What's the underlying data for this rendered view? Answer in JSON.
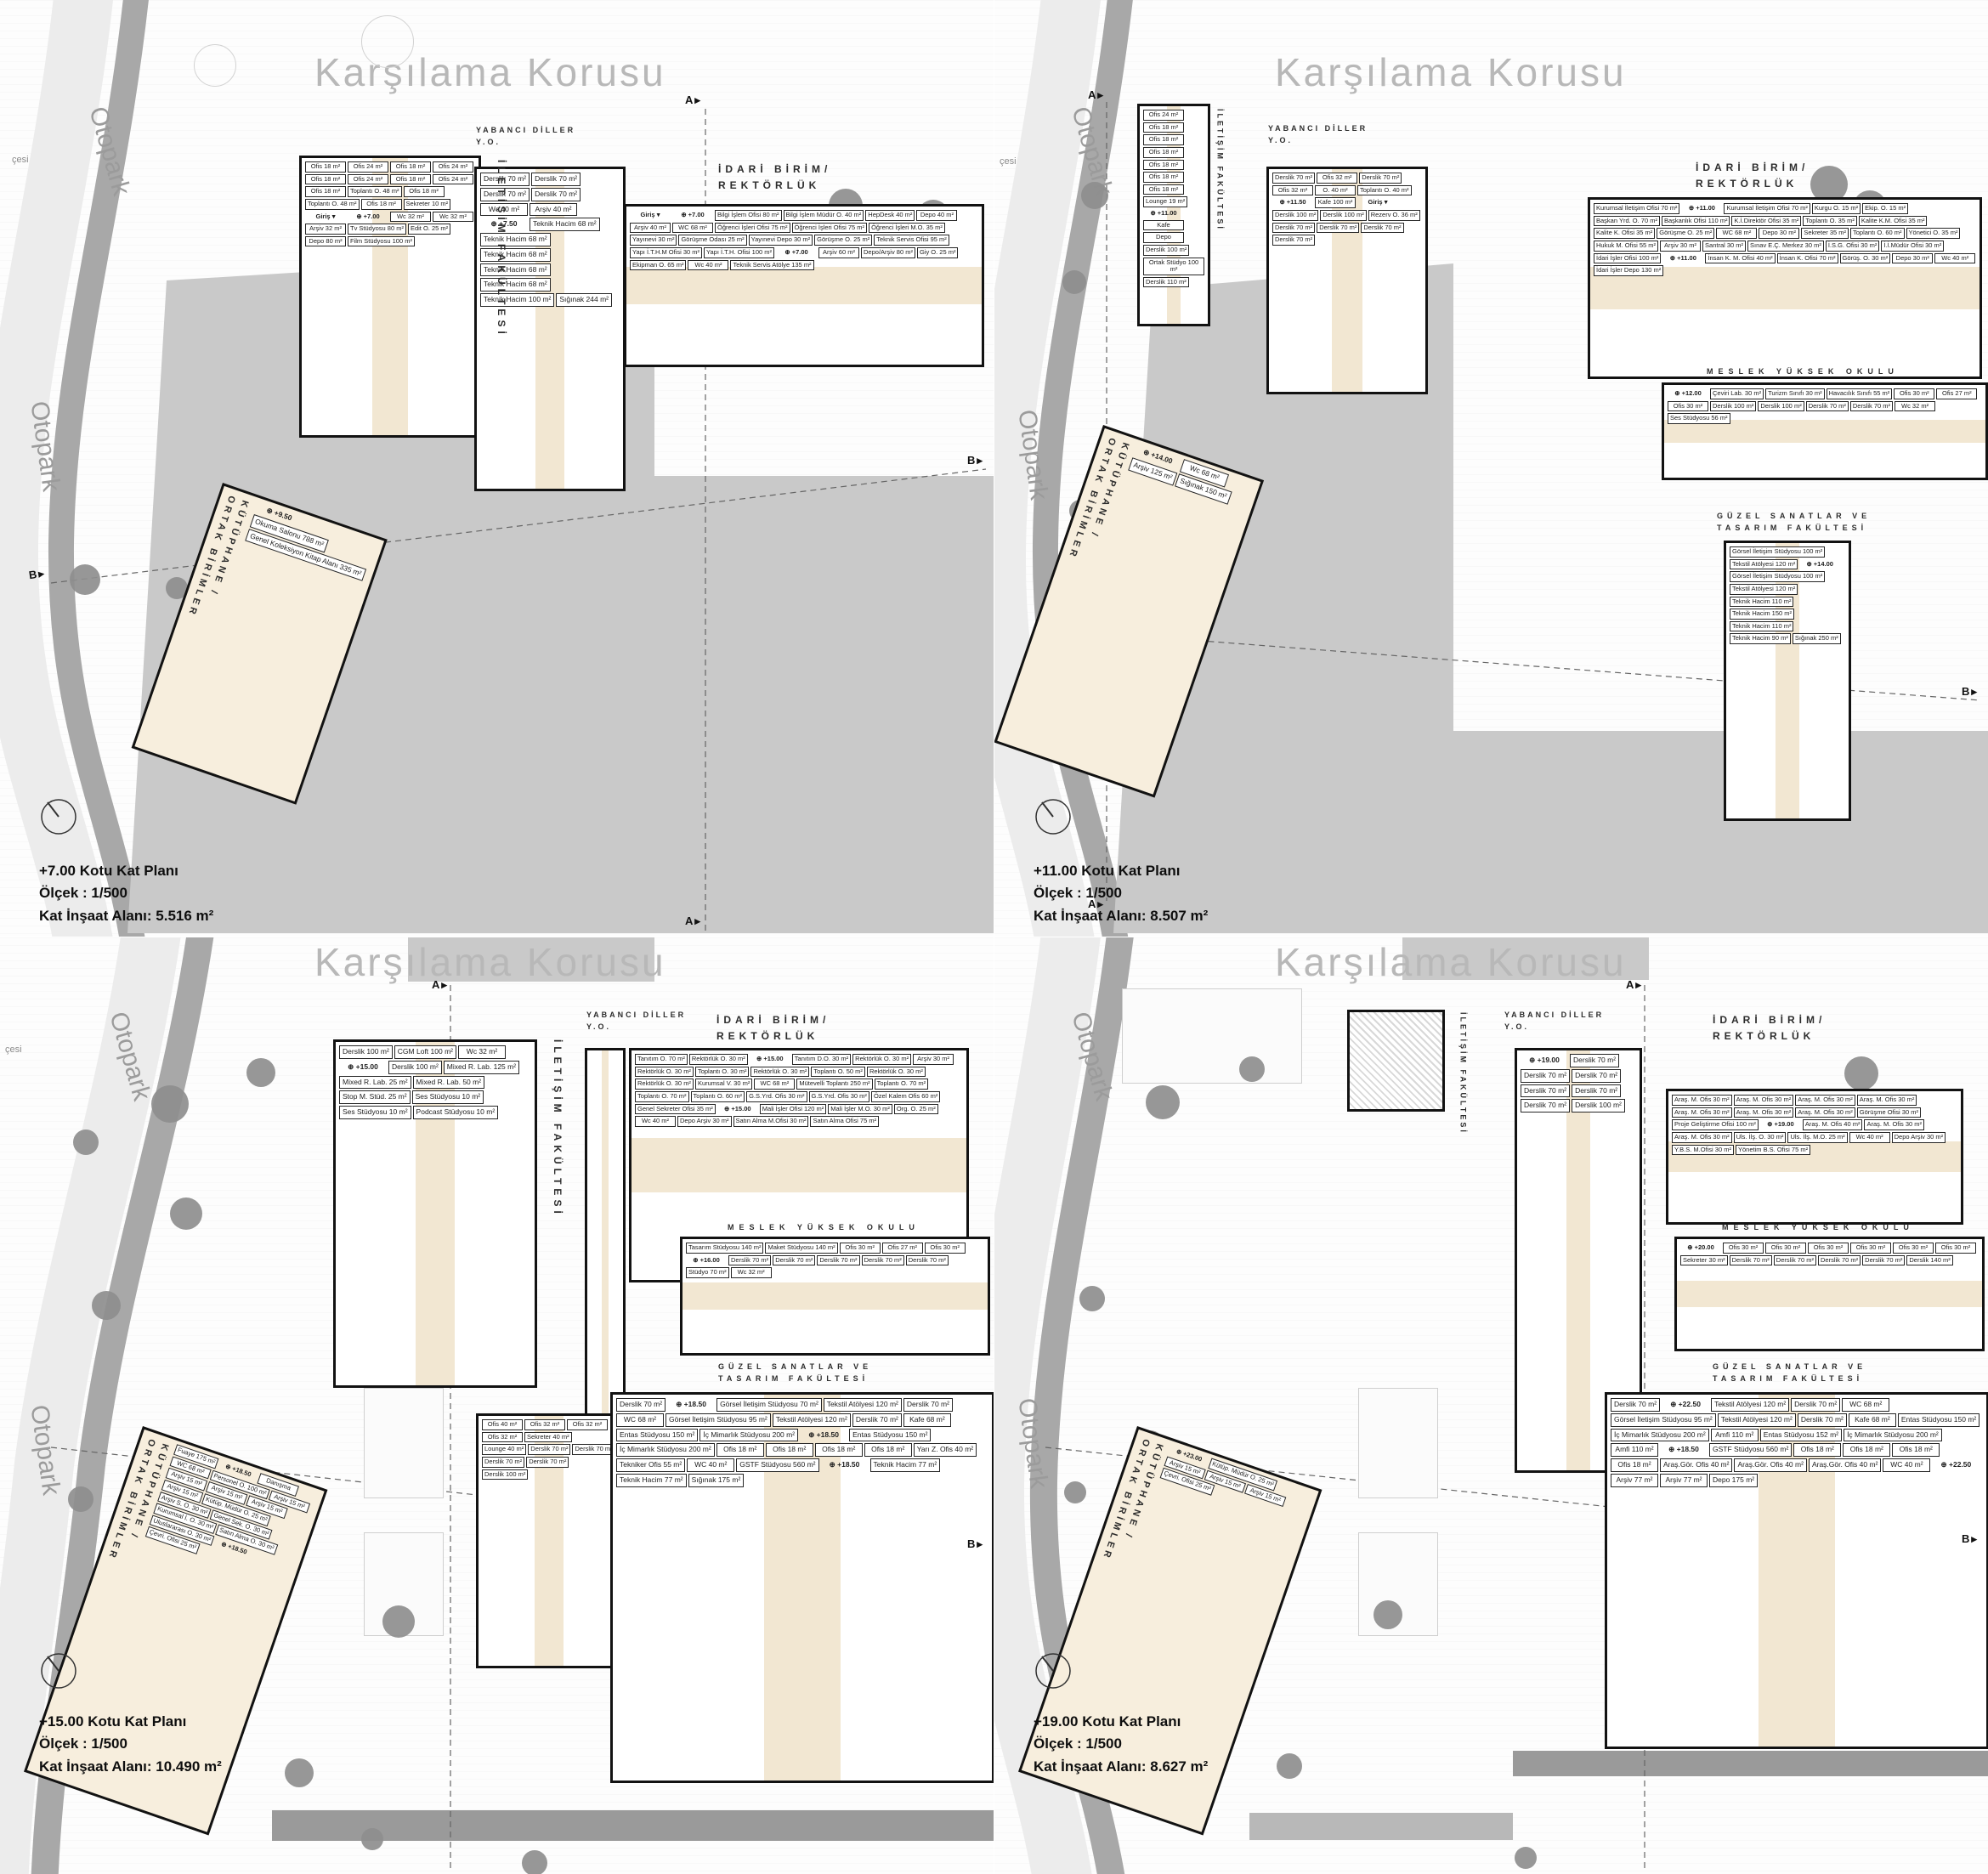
{
  "colors": {
    "corridor": "#f2e7d2",
    "plaza": "#c9c9c9",
    "road": "#a8a8a8",
    "tree": "#8e8e8e",
    "wall": "#121212"
  },
  "quadrants": [
    {
      "id": "plan-7",
      "title": "+7.00 Kotu Kat Planı",
      "scale": "Ölçek : 1/500",
      "area": "Kat İnşaat Alanı: 5.516 m²",
      "context": {
        "forest": "Karşılama Korusu",
        "otopark": "Otopark",
        "street": "çesi"
      },
      "sections": {
        "a": "A",
        "b": "B"
      },
      "buildings": {
        "iletisim": {
          "name": "İLETİŞİM FAKÜLTESİ",
          "rooms": [
            "Ofis 18 m²",
            "Ofis 24 m²",
            "Ofis 18 m²",
            "Ofis 24 m²",
            "Ofis 18 m²",
            "Ofis 24 m²",
            "Ofis 18 m²",
            "Ofis 24 m²",
            "Ofis 18 m²",
            "Toplantı O. 48 m²",
            "Ofis 18 m²",
            "Toplantı O. 48 m²",
            "Ofis 18 m²",
            "Sekreter 10 m²",
            "Giriş",
            "⊕ +7.00",
            "Wc 32 m²",
            "Wc 32 m²",
            "Arşiv 32 m²",
            "Tv Stüdyosu 80 m²",
            "Edit O. 25 m²",
            "Depo 80 m²",
            "Film Stüdyosu 100 m²"
          ]
        },
        "yabanci": {
          "name": "YABANCI DİLLER\nY.O.",
          "rooms": [
            "Derslik 70 m²",
            "Derslik 70 m²",
            "Derslik 70 m²",
            "Derslik 70 m²",
            "Wc 40 m²",
            "Arşiv 40 m²",
            "⊕ +7.50",
            "Teknik Hacim 68 m²",
            "Teknik Hacim 68 m²",
            "Teknik Hacim 68 m²",
            "Teknik Hacim 68 m²",
            "Teknik Hacim 68 m²",
            "Teknik Hacim 100 m²",
            "Sığınak 244 m²"
          ]
        },
        "idari": {
          "name": "İDARİ BİRİM/\nREKTÖRLÜK",
          "rooms": [
            "Giriş",
            "⊕ +7.00",
            "Bilgi İşlem Ofisi 80 m²",
            "Bilgi İşlem Müdür O. 40 m²",
            "HepDesk 40 m²",
            "Depo 40 m²",
            "Arşiv 40 m²",
            "WC 68 m²",
            "Öğrenci İşleri Ofisi 75 m²",
            "Öğrenci İşleri Ofisi 75 m²",
            "Öğrenci İşleri M.O. 35 m²",
            "Yayınevi 30 m²",
            "Görüşme Odası 25 m²",
            "Yayınevi Depo 30 m²",
            "Görüşme O. 25 m²",
            "Teknik Servis Ofisi 95 m²",
            "Yapı İ.T.H.M Ofisi 30 m²",
            "Yapı İ.T.H. Ofisi 100 m²",
            "⊕ +7.00",
            "Arşiv 60 m²",
            "Depo/Arşiv 80 m²",
            "Giy O. 25 m²",
            "Ekipman O. 65 m²",
            "Wc 40 m²",
            "Teknik Servis Atölye 135 m²"
          ]
        },
        "kutuphane": {
          "name": "KÜTÜPHANE /\nORTAK BİRİMLER",
          "rooms": [
            "⊕ +9.50",
            "Okuma Salonu 788 m²",
            "Genel Koleksiyon Kitap Alanı 335 m²"
          ]
        }
      }
    },
    {
      "id": "plan-11",
      "title": "+11.00 Kotu Kat Planı",
      "scale": "Ölçek : 1/500",
      "area": "Kat İnşaat Alanı: 8.507 m²",
      "context": {
        "forest": "Karşılama Korusu",
        "otopark": "Otopark",
        "street": "çesi"
      },
      "sections": {
        "a": "A",
        "b": "B"
      },
      "buildings": {
        "iletisim": {
          "name": "İLETİŞİM FAKÜLTESİ",
          "rooms": [
            "Ofis 24 m²",
            "Ofis 18 m²",
            "Ofis 18 m²",
            "Ofis 18 m²",
            "Ofis 18 m²",
            "Ofis 18 m²",
            "Ofis 18 m²",
            "Lounge 19 m²",
            "⊕ +11.00",
            "Kafe",
            "Depo",
            "Derslik 100 m²",
            "Ortak Stüdyo 100 m²",
            "Derslik 110 m²"
          ]
        },
        "yabanci": {
          "name": "YABANCI DİLLER\nY.O.",
          "rooms": [
            "Derslik 70 m²",
            "Ofis 32 m²",
            "Derslik 70 m²",
            "Ofis 32 m²",
            "O. 40 m²",
            "Toplantı O. 40 m²",
            "⊕ +11.50",
            "Kafe 100 m²",
            "Giriş",
            "Derslik 100 m²",
            "Derslik 100 m²",
            "Rezerv O. 36 m²",
            "Derslik 70 m²",
            "Derslik 70 m²",
            "Derslik 70 m²",
            "Derslik 70 m²"
          ]
        },
        "idari": {
          "name": "İDARİ BİRİM/\nREKTÖRLÜK",
          "rooms": [
            "Kurumsal İletişim Ofisi 70 m²",
            "⊕ +11.00",
            "Kurumsal İletişim Ofisi 70 m²",
            "Kurgu O. 15 m²",
            "Ekip. O. 15 m²",
            "Başkan Yrd. O. 70 m²",
            "Başkanlık Ofisi 110 m²",
            "K.İ.Direktör Ofisi 35 m²",
            "Toplantı O. 35 m²",
            "Kalite K.M. Ofisi 35 m²",
            "Kalite K. Ofisi 35 m²",
            "Görüşme O. 25 m²",
            "WC 68 m²",
            "Depo 30 m²",
            "Sekreter 35 m²",
            "Toplantı O. 60 m²",
            "Yönetici O. 35 m²",
            "Hukuk M. Ofisi 55 m²",
            "Arşiv 30 m²",
            "Santral 30 m²",
            "Sınav E.Ç. Merkez 30 m²",
            "İ.S.G. Ofisi 30 m²",
            "İ.İ.Müdür Ofisi 30 m²",
            "İdari İşler Ofisi 100 m²",
            "⊕ +11.00",
            "İnsan K. M. Ofisi 40 m²",
            "İnsan K. Ofisi 70 m²",
            "Görüş. O. 30 m²",
            "Depo 30 m²",
            "Wc 40 m²",
            "İdari İşler Depo 130 m²"
          ]
        },
        "meslek": {
          "name": "MESLEK YÜKSEK OKULU",
          "rooms": [
            "⊕ +12.00",
            "Çeviri Lab. 30 m²",
            "Turizm Sınıfı 30 m²",
            "Havacılık Sınıfı 55 m²",
            "Ofis 30 m²",
            "Ofis 27 m²",
            "Ofis 30 m²",
            "Derslik 100 m²",
            "Derslik 100 m²",
            "Derslik 70 m²",
            "Derslik 70 m²",
            "Wc 32 m²",
            "Ses Stüdyosu 56 m²"
          ]
        },
        "guzel": {
          "name": "GÜZEL SANATLAR VE\nTASARIM FAKÜLTESİ",
          "rooms": [
            "Görsel İletişim Stüdyosu 100 m²",
            "Tekstil Atölyesi 120 m²",
            "⊕ +14.00",
            "Görsel İletişim Stüdyosu 100 m²",
            "Tekstil Atölyesi 120 m²",
            "Teknik Hacim 110 m²",
            "Teknik Hacim 150 m²",
            "Teknik Hacim 110 m²",
            "Teknik Hacim 90 m²",
            "Sığınak 250 m²"
          ]
        },
        "kutuphane": {
          "name": "KÜTÜPHANE /\nORTAK BİRİMLER",
          "rooms": [
            "⊕ +14.00",
            "Wc 68 m²",
            "Arşiv 125 m²",
            "Sığınak 150 m²"
          ]
        }
      }
    },
    {
      "id": "plan-15",
      "title": "+15.00 Kotu Kat Planı",
      "scale": "Ölçek : 1/500",
      "area": "Kat İnşaat Alanı: 10.490 m²",
      "context": {
        "forest": "Karşılama Korusu",
        "otopark": "Otopark",
        "street": "çesi"
      },
      "sections": {
        "a": "A",
        "b": "B"
      },
      "buildings": {
        "iletisim": {
          "name": "İLETİŞİM FAKÜLTESİ",
          "rooms": [
            "Derslik 100 m²",
            "CGM Loft 100 m²",
            "Wc 32 m²",
            "⊕ +15.00",
            "Derslik 100 m²",
            "Mixed R. Lab. 125 m²",
            "Mixed R. Lab. 25 m²",
            "Mixed R. Lab. 50 m²",
            "Stop M. Stüd. 25 m²",
            "Ses Stüdyosu 10 m²",
            "Ses Stüdyosu 10 m²",
            "Podcast Stüdyosu 10 m²"
          ]
        },
        "yabanci": {
          "name": "YABANCI DİLLER\nY.O.",
          "rooms": [
            "Ofis 40 m²",
            "Ofis 32 m²",
            "Ofis 32 m²",
            "Ofis 32 m²",
            "Sekreter 40 m²",
            "Lounge 40 m²",
            "Derslik 70 m²",
            "Derslik 70 m²",
            "Derslik 70 m²",
            "Derslik 70 m²",
            "Derslik 100 m²"
          ]
        },
        "idari": {
          "name": "İDARİ BİRİM/\nREKTÖRLÜK",
          "rooms": [
            "Tanıtım O. 70 m²",
            "Rektörlük O. 30 m²",
            "⊕ +15.00",
            "Tanıtım D.O. 30 m²",
            "Rektörlük O. 30 m²",
            "Arşiv 30 m²",
            "Rektörlük O. 30 m²",
            "Toplantı O. 30 m²",
            "Rektörlük O. 30 m²",
            "Toplantı O. 50 m²",
            "Rektörlük O. 30 m²",
            "Rektörlük O. 30 m²",
            "Kurumsal V. 30 m²",
            "WC 68 m²",
            "Mütevelli Toplantı 250 m²",
            "Toplantı O. 70 m²",
            "Toplantı O. 70 m²",
            "Toplantı O. 60 m²",
            "G.S.Yrd. Ofis 30 m²",
            "G.S.Yrd. Ofis 30 m²",
            "Özel Kalem Ofis 60 m²",
            "Genel Sekreter Ofisi 35 m²",
            "⊕ +15.00",
            "Mali İşler Ofisi 120 m²",
            "Mali İşler M.O. 30 m²",
            "Org. O. 25 m²",
            "Wc 40 m²",
            "Depo Arşiv 30 m²",
            "Satın Alma M.Ofisi 30 m²",
            "Satın Alma Ofisi 75 m²"
          ]
        },
        "meslek": {
          "name": "MESLEK YÜKSEK OKULU",
          "rooms": [
            "Tasarım Stüdyosu 140 m²",
            "Maket Stüdyosu 140 m²",
            "Ofis 30 m²",
            "Ofis 27 m²",
            "Ofis 30 m²",
            "⊕ +16.00",
            "Derslik 70 m²",
            "Derslik 70 m²",
            "Derslik 70 m²",
            "Derslik 70 m²",
            "Derslik 70 m²",
            "Stüdyo 70 m²",
            "Wc 32 m²"
          ]
        },
        "guzel": {
          "name": "GÜZEL SANATLAR VE\nTASARIM FAKÜLTESİ",
          "rooms": [
            "Derslik 70 m²",
            "⊕ +18.50",
            "Görsel İletişim Stüdyosu 70 m²",
            "Tekstil Atölyesi 120 m²",
            "Derslik 70 m²",
            "WC 68 m²",
            "Görsel İletişim Stüdyosu 95 m²",
            "Tekstil Atölyesi 120 m²",
            "Derslik 70 m²",
            "Kafe 68 m²",
            "Entas Stüdyosu 150 m²",
            "İç Mimarlık Stüdyosu 200 m²",
            "⊕ +18.50",
            "Entas Stüdyosu 150 m²",
            "İç Mimarlık Stüdyosu 200 m²",
            "Ofis 18 m²",
            "Ofis 18 m²",
            "Ofis 18 m²",
            "Ofis 18 m²",
            "Yarı Z. Ofis 40 m²",
            "Tekniker Ofis 55 m²",
            "WC 40 m²",
            "GSTF Stüdyosu 560 m²",
            "⊕ +18.50",
            "Teknik Hacim 77 m²",
            "Teknik Hacim 77 m²",
            "Sığınak 175 m²"
          ]
        },
        "kutuphane": {
          "name": "KÜTÜPHANE /\nORTAK BİRİMLER",
          "rooms": [
            "Fuaye 175 m²",
            "⊕ +18.50",
            "Danışma",
            "WC 68 m²",
            "Personel O. 100 m²",
            "Arşiv 15 m²",
            "Arşiv 15 m²",
            "Arşiv 15 m²",
            "Arşiv 15 m²",
            "Arşiv 15 m²",
            "Kütüp. Müdür O. 25 m²",
            "Arşiv S. O. 30 m²",
            "Genel Sek. O. 30 m²",
            "Kurumsal İ. O. 30 m²",
            "Satın Alma O. 30 m²",
            "Uluslararası O. 30 m²",
            "⊕ +18.50",
            "Çevri. Ofisi 25 m²"
          ]
        }
      }
    },
    {
      "id": "plan-19",
      "title": "+19.00 Kotu Kat Planı",
      "scale": "Ölçek : 1/500",
      "area": "Kat İnşaat Alanı: 8.627 m²",
      "context": {
        "forest": "Karşılama Korusu",
        "otopark": "Otopark",
        "street": "çesi"
      },
      "sections": {
        "a": "A",
        "b": "B"
      },
      "buildings": {
        "iletisim": {
          "name": "İLETİŞİM FAKÜLTESİ",
          "rooms": []
        },
        "yabanci": {
          "name": "YABANCI DİLLER\nY.O.",
          "rooms": [
            "⊕ +19.00",
            "Derslik 70 m²",
            "Derslik 70 m²",
            "Derslik 70 m²",
            "Derslik 70 m²",
            "Derslik 70 m²",
            "Derslik 70 m²",
            "Derslik 100 m²"
          ]
        },
        "idari": {
          "name": "İDARİ BİRİM/\nREKTÖRLÜK",
          "rooms": [
            "Araş. M. Ofis 30 m²",
            "Araş. M. Ofis 30 m²",
            "Araş. M. Ofis 30 m²",
            "Araş. M. Ofis 30 m²",
            "Araş. M. Ofis 30 m²",
            "Araş. M. Ofis 30 m²",
            "Araş. M. Ofis 30 m²",
            "Görüşme Ofisi 30 m²",
            "Proje Geliştirme Ofisi 100 m²",
            "⊕ +19.00",
            "Araş. M. Ofis 40 m²",
            "Araş. M. Ofis 30 m²",
            "Araş. M. Ofis 30 m²",
            "Uls. İlş. O. 30 m²",
            "Uls. İlş. M.O. 25 m²",
            "Wc 40 m²",
            "Depo Arşiv 30 m²",
            "Y.B.S. M.Ofisi 30 m²",
            "Yönetim B.S. Ofisi 75 m²"
          ]
        },
        "meslek": {
          "name": "MESLEK YÜKSEK OKULU",
          "rooms": [
            "⊕ +20.00",
            "Ofis 30 m²",
            "Ofis 30 m²",
            "Ofis 30 m²",
            "Ofis 30 m²",
            "Ofis 30 m²",
            "Ofis 30 m²",
            "Sekreter 30 m²",
            "Derslik 70 m²",
            "Derslik 70 m²",
            "Derslik 70 m²",
            "Derslik 70 m²",
            "Derslik 140 m²"
          ]
        },
        "guzel": {
          "name": "GÜZEL SANATLAR VE\nTASARIM FAKÜLTESİ",
          "rooms": [
            "Derslik 70 m²",
            "⊕ +22.50",
            "Tekstil Atölyesi 120 m²",
            "Derslik 70 m²",
            "WC 68 m²",
            "Görsel İletişim Stüdyosu 95 m²",
            "Tekstil Atölyesi 120 m²",
            "Derslik 70 m²",
            "Kafe 68 m²",
            "Entas Stüdyosu 150 m²",
            "İç Mimarlık Stüdyosu 200 m²",
            "Amfi 110 m²",
            "Entas Stüdyosu 152 m²",
            "İç Mimarlık Stüdyosu 200 m²",
            "Amfi 110 m²",
            "⊕ +18.50",
            "GSTF Stüdyosu 560 m²",
            "Ofis 18 m²",
            "Ofis 18 m²",
            "Ofis 18 m²",
            "Ofis 18 m²",
            "Araş.Gör. Ofis 40 m²",
            "Araş.Gör. Ofis 40 m²",
            "Araş.Gör. Ofis 40 m²",
            "WC 40 m²",
            "⊕ +22.50",
            "Arşiv 77 m²",
            "Arşiv 77 m²",
            "Depo 175 m²"
          ]
        },
        "kutuphane": {
          "name": "KÜTÜPHANE /\nORTAK BİRİMLER",
          "rooms": [
            "⊕ +23.00",
            "Kütüp. Müdür O. 25 m²",
            "Arşiv 15 m²",
            "Arşiv 15 m²",
            "Arşiv 15 m²",
            "Çevri. Ofisi 25 m²"
          ]
        }
      }
    }
  ]
}
